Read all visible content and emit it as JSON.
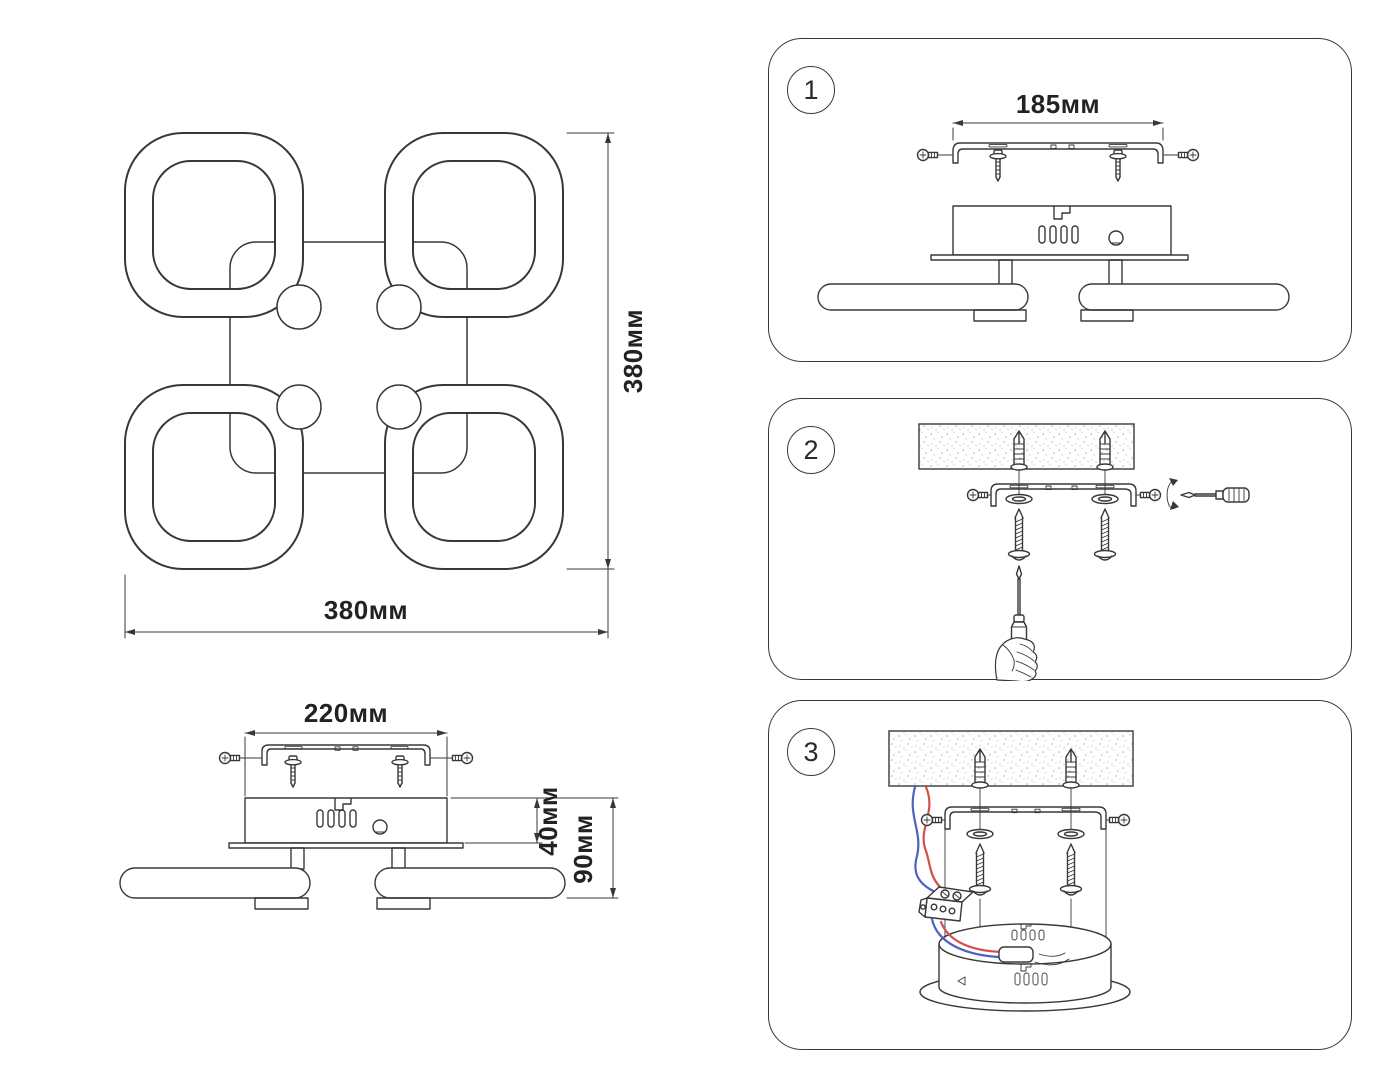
{
  "top_view": {
    "width_dim": "380мм",
    "height_dim": "380мм"
  },
  "side_view": {
    "width_dim": "220мм",
    "body_height_dim": "40мм",
    "total_height_dim": "90мм"
  },
  "steps": [
    {
      "number": "1",
      "bracket_dim": "185мм"
    },
    {
      "number": "2"
    },
    {
      "number": "3"
    }
  ],
  "colors": {
    "line": "#383838",
    "dim_text": "#222222",
    "wire_live_red": "#d0504a",
    "wire_neutral_blue": "#5060c0",
    "ceiling_stipple": "#c4c4c4"
  }
}
